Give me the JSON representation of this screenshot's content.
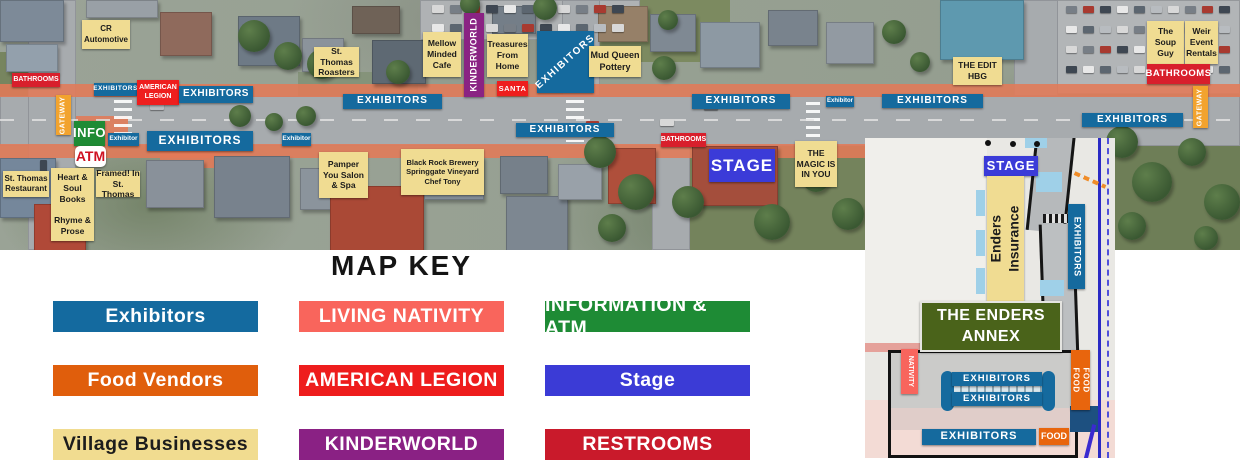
{
  "map_key": {
    "title": "MAP KEY",
    "items": [
      {
        "id": "exhibitors",
        "label": "Exhibitors",
        "color": "#146a9f",
        "text_color": "#ffffff"
      },
      {
        "id": "living-nativity",
        "label": "LIVING NATIVITY",
        "color": "#f9655c",
        "text_color": "#ffffff"
      },
      {
        "id": "information-atm",
        "label": "INFORMATION & ATM",
        "color": "#1e8b35",
        "text_color": "#ffffff"
      },
      {
        "id": "food-vendors",
        "label": "Food Vendors",
        "color": "#e05e0c",
        "text_color": "#ffffff"
      },
      {
        "id": "american-legion",
        "label": "AMERICAN LEGION",
        "color": "#ee1d1d",
        "text_color": "#ffffff"
      },
      {
        "id": "stage",
        "label": "Stage",
        "color": "#3b3bd6",
        "text_color": "#ffffff"
      },
      {
        "id": "village-businesses",
        "label": "Village Businesses",
        "color": "#f1dc90",
        "text_color": "#1c1c1c"
      },
      {
        "id": "kinderworld",
        "label": "KINDERWORLD",
        "color": "#8a2184",
        "text_color": "#ffffff"
      },
      {
        "id": "restrooms",
        "label": "RESTROOMS",
        "color": "#c91a2b",
        "text_color": "#ffffff"
      }
    ]
  },
  "map_labels": [
    {
      "name": "label-cr-automotive",
      "cls": "c-yel",
      "text": "CR\nAutomotive",
      "x": 82,
      "y": 20,
      "w": 48,
      "h": 29,
      "fs": 8
    },
    {
      "name": "label-bathrooms-west",
      "cls": "c-bath",
      "text": "BATHROOMS",
      "x": 12,
      "y": 73,
      "w": 48,
      "h": 14,
      "fs": 7
    },
    {
      "name": "label-exhibitors-1",
      "cls": "c-exh",
      "text": "EXHIBITORS",
      "x": 94,
      "y": 83,
      "w": 43,
      "h": 13,
      "fs": 6.5,
      "ls": 0.5
    },
    {
      "name": "label-american-legion",
      "cls": "c-red",
      "text": "AMERICAN\nLEGION",
      "x": 137,
      "y": 80,
      "w": 42,
      "h": 25,
      "fs": 7
    },
    {
      "name": "label-exhibitors-2",
      "cls": "c-exh",
      "text": "EXHIBITORS",
      "x": 179,
      "y": 86,
      "w": 74,
      "h": 17,
      "fs": 10,
      "ls": 0.5
    },
    {
      "name": "label-gateway-west",
      "cls": "c-org",
      "text": "GATEWAY",
      "x": 56,
      "y": 95,
      "w": 15,
      "h": 40,
      "fs": 7,
      "rot": "up",
      "ls": 0.5
    },
    {
      "name": "label-info",
      "cls": "c-grn",
      "text": "INFO",
      "x": 74,
      "y": 121,
      "w": 31,
      "h": 25,
      "fs": 13,
      "ls": 0.5
    },
    {
      "name": "label-exhibitor-a",
      "cls": "c-exh",
      "text": "Exhibitor",
      "x": 108,
      "y": 133,
      "w": 31,
      "h": 13,
      "fs": 6.5
    },
    {
      "name": "label-exhibitors-3",
      "cls": "c-exh",
      "text": "EXHIBITORS",
      "x": 147,
      "y": 131,
      "w": 106,
      "h": 20,
      "fs": 12,
      "ls": 1
    },
    {
      "name": "label-atm",
      "cls": "c-atm",
      "text": "ATM",
      "x": 75,
      "y": 146,
      "w": 31,
      "h": 21,
      "fs": 14
    },
    {
      "name": "label-exhibitor-b",
      "cls": "c-exh",
      "text": "Exhibitor",
      "x": 282,
      "y": 133,
      "w": 29,
      "h": 13,
      "fs": 6.5
    },
    {
      "name": "label-st-thomas-restaurant",
      "cls": "c-yel",
      "text": "St. Thomas\nRestaurant",
      "x": 3,
      "y": 171,
      "w": 46,
      "h": 26,
      "fs": 8
    },
    {
      "name": "label-heart-soul-books",
      "cls": "c-yel",
      "text": "Heart &\nSoul\nBooks\n\nRhyme &\nProse",
      "x": 51,
      "y": 168,
      "w": 43,
      "h": 73,
      "fs": 8.5
    },
    {
      "name": "label-framed-in-st-thomas",
      "cls": "c-yel",
      "text": "Framed! In\nSt. Thomas",
      "x": 96,
      "y": 171,
      "w": 44,
      "h": 26,
      "fs": 8.5
    },
    {
      "name": "label-st-thomas-roasters",
      "cls": "c-yel",
      "text": "St. Thomas\nRoasters",
      "x": 314,
      "y": 47,
      "w": 45,
      "h": 30,
      "fs": 8.5
    },
    {
      "name": "label-exhibitors-4",
      "cls": "c-exh",
      "text": "EXHIBITORS",
      "x": 343,
      "y": 94,
      "w": 99,
      "h": 15,
      "fs": 10,
      "ls": 1
    },
    {
      "name": "label-mellow-minded-cafe",
      "cls": "c-yel",
      "text": "Mellow\nMinded\nCafe",
      "x": 423,
      "y": 32,
      "w": 38,
      "h": 45,
      "fs": 8.5
    },
    {
      "name": "label-kinderworld",
      "cls": "c-pur",
      "text": "KINDERWORLD",
      "x": 464,
      "y": 13,
      "w": 20,
      "h": 84,
      "fs": 9,
      "rot": "up",
      "ls": 0.5
    },
    {
      "name": "label-treasures-from-home",
      "cls": "c-yel",
      "text": "Treasures\nFrom\nHome",
      "x": 487,
      "y": 34,
      "w": 41,
      "h": 43,
      "fs": 8.5
    },
    {
      "name": "label-santa",
      "cls": "c-red",
      "text": "SANTA",
      "x": 497,
      "y": 81,
      "w": 31,
      "h": 15,
      "fs": 7.5,
      "ls": 0.5
    },
    {
      "name": "label-exhibitors-block",
      "cls": "c-exh",
      "text": "EXHIBITORS",
      "x": 537,
      "y": 31,
      "w": 57,
      "h": 62,
      "fs": 10,
      "rot": "diag",
      "ls": 1.5
    },
    {
      "name": "label-mud-queen-pottery",
      "cls": "c-yel",
      "text": "Mud Queen\nPottery",
      "x": 589,
      "y": 46,
      "w": 52,
      "h": 31,
      "fs": 9
    },
    {
      "name": "label-exhibitors-5",
      "cls": "c-exh",
      "text": "EXHIBITORS",
      "x": 516,
      "y": 123,
      "w": 98,
      "h": 14,
      "fs": 10,
      "ls": 1
    },
    {
      "name": "label-pamper-you-salon",
      "cls": "c-yel",
      "text": "Pamper\nYou Salon\n& Spa",
      "x": 319,
      "y": 152,
      "w": 49,
      "h": 46,
      "fs": 8.5
    },
    {
      "name": "label-black-rock-brewery",
      "cls": "c-yel",
      "text": "Black Rock Brewery\nSpringgate Vineyard\nChef Tony",
      "x": 401,
      "y": 149,
      "w": 83,
      "h": 46,
      "fs": 7.5
    },
    {
      "name": "label-exhibitors-6",
      "cls": "c-exh",
      "text": "EXHIBITORS",
      "x": 692,
      "y": 94,
      "w": 98,
      "h": 15,
      "fs": 10,
      "ls": 1
    },
    {
      "name": "label-exhibitor-c",
      "cls": "c-exh",
      "text": "Exhibitor",
      "x": 826,
      "y": 96,
      "w": 28,
      "h": 11,
      "fs": 6
    },
    {
      "name": "label-exhibitors-7",
      "cls": "c-exh",
      "text": "EXHIBITORS",
      "x": 882,
      "y": 94,
      "w": 101,
      "h": 14,
      "fs": 10,
      "ls": 1
    },
    {
      "name": "label-bathrooms-mid",
      "cls": "c-bath",
      "text": "BATHROOMS",
      "x": 661,
      "y": 133,
      "w": 45,
      "h": 14,
      "fs": 7
    },
    {
      "name": "label-stage-main",
      "cls": "c-stg",
      "text": "STAGE",
      "x": 709,
      "y": 149,
      "w": 66,
      "h": 33,
      "fs": 17,
      "ls": 1
    },
    {
      "name": "label-the-magic-is-in-you",
      "cls": "c-yel",
      "text": "THE\nMAGIC IS\nIN YOU",
      "x": 795,
      "y": 141,
      "w": 42,
      "h": 46,
      "fs": 8.5
    },
    {
      "name": "label-the-edit-hbg",
      "cls": "c-yel",
      "text": "THE EDIT\nHBG",
      "x": 953,
      "y": 57,
      "w": 49,
      "h": 28,
      "fs": 8.5
    },
    {
      "name": "label-the-soup-guy",
      "cls": "c-yel",
      "text": "The\nSoup\nGuy",
      "x": 1147,
      "y": 21,
      "w": 37,
      "h": 43,
      "fs": 8.5
    },
    {
      "name": "label-weir-event-rentals",
      "cls": "c-yel",
      "text": "Weir\nEvent\nRentals",
      "x": 1185,
      "y": 21,
      "w": 33,
      "h": 43,
      "fs": 8.5
    },
    {
      "name": "label-bathrooms-east",
      "cls": "c-bath",
      "text": "BATHROOMS",
      "x": 1147,
      "y": 64,
      "w": 63,
      "h": 20,
      "fs": 9.5,
      "ls": 0.5
    },
    {
      "name": "label-gateway-east",
      "cls": "c-org",
      "text": "GATEWAY",
      "x": 1193,
      "y": 86,
      "w": 15,
      "h": 42,
      "fs": 7,
      "rot": "up",
      "ls": 0.5
    },
    {
      "name": "label-exhibitors-8",
      "cls": "c-exh",
      "text": "EXHIBITORS",
      "x": 1082,
      "y": 113,
      "w": 101,
      "h": 14,
      "fs": 10,
      "ls": 1
    },
    {
      "name": "label-stage-annex",
      "cls": "c-stg",
      "text": "STAGE",
      "x": 984,
      "y": 156,
      "w": 54,
      "h": 20,
      "fs": 13,
      "ls": 1
    },
    {
      "name": "label-enders-insurance",
      "cls": "c-yel",
      "text": "Enders Insurance",
      "x": 987,
      "y": 176,
      "w": 37,
      "h": 126,
      "fs": 14,
      "rot": "up"
    },
    {
      "name": "label-exhibitors-annex-vertical",
      "cls": "c-exh",
      "text": "EXHIBITORS",
      "x": 1068,
      "y": 204,
      "w": 17,
      "h": 85,
      "fs": 9,
      "rot": "down",
      "ls": 0.5
    },
    {
      "name": "label-the-enders-annex",
      "cls": "c-anx",
      "text": "THE ENDERS\nANNEX",
      "x": 920,
      "y": 301,
      "w": 138,
      "h": 47,
      "fs": 16,
      "ls": 0.5
    },
    {
      "name": "label-nativity",
      "cls": "c-nat",
      "text": "NATIVITY",
      "x": 901,
      "y": 349,
      "w": 17,
      "h": 45,
      "fs": 7,
      "rot": "down"
    },
    {
      "name": "label-food-food",
      "cls": "c-food",
      "text": "FOOD FOOD",
      "x": 1071,
      "y": 350,
      "w": 19,
      "h": 60,
      "fs": 8,
      "rot": "down",
      "ls": 0.5
    },
    {
      "name": "label-exhibitors-annex-1",
      "cls": "c-exh",
      "text": "EXHIBITORS",
      "x": 952,
      "y": 372,
      "w": 90,
      "h": 14,
      "fs": 9.5,
      "ls": 1
    },
    {
      "name": "label-exhibitors-annex-2",
      "cls": "c-exh",
      "text": "EXHIBITORS",
      "x": 952,
      "y": 392,
      "w": 90,
      "h": 14,
      "fs": 9.5,
      "ls": 1
    },
    {
      "name": "label-exhibitors-annex-3",
      "cls": "c-exh",
      "text": "EXHIBITORS",
      "x": 922,
      "y": 429,
      "w": 114,
      "h": 16,
      "fs": 11,
      "ls": 1
    },
    {
      "name": "label-food",
      "cls": "c-food",
      "text": "FOOD",
      "x": 1039,
      "y": 428,
      "w": 30,
      "h": 17,
      "fs": 9
    }
  ]
}
